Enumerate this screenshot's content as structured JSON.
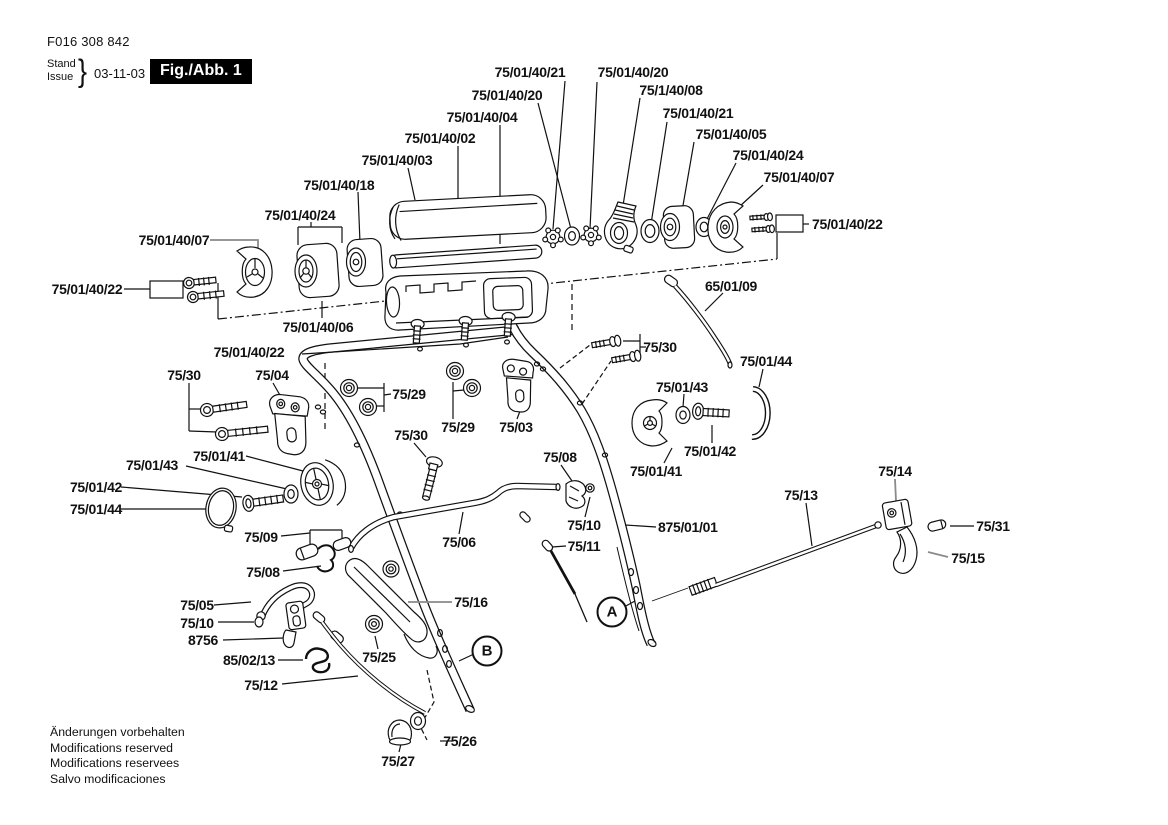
{
  "header": {
    "part_code": "F016 308 842",
    "stand_label": "Stand",
    "issue_label": "Issue",
    "brace": "}",
    "date": "03-11-03",
    "figure_badge": "Fig./Abb. 1"
  },
  "footer": {
    "lines": [
      "Änderungen vorbehalten",
      "Modifications reserved",
      "Modifications reservees",
      "Salvo modificaciones"
    ]
  },
  "colors": {
    "ink": "#111111",
    "badge_bg": "#000000",
    "badge_text": "#ffffff",
    "leader_gray": "#8a8a8a"
  },
  "view_markers": [
    {
      "letter": "A",
      "x": 612,
      "y": 612
    },
    {
      "letter": "B",
      "x": 487,
      "y": 651
    }
  ],
  "labels": [
    {
      "text": "75/01/40/21",
      "x": 530,
      "y": 72
    },
    {
      "text": "75/01/40/20",
      "x": 633,
      "y": 72
    },
    {
      "text": "75/01/40/20",
      "x": 507,
      "y": 95
    },
    {
      "text": "75/1/40/08",
      "x": 671,
      "y": 90
    },
    {
      "text": "75/01/40/04",
      "x": 482,
      "y": 117
    },
    {
      "text": "75/01/40/21",
      "x": 698,
      "y": 113
    },
    {
      "text": "75/01/40/02",
      "x": 440,
      "y": 138
    },
    {
      "text": "75/01/40/05",
      "x": 731,
      "y": 134
    },
    {
      "text": "75/01/40/03",
      "x": 397,
      "y": 160
    },
    {
      "text": "75/01/40/24",
      "x": 768,
      "y": 155
    },
    {
      "text": "75/01/40/18",
      "x": 339,
      "y": 185
    },
    {
      "text": "75/01/40/07",
      "x": 799,
      "y": 177
    },
    {
      "text": "75/01/40/24",
      "x": 300,
      "y": 215
    },
    {
      "text": "75/01/40/07",
      "x": 174,
      "y": 240
    },
    {
      "text": "75/01/40/22",
      "x": 812,
      "y": 224,
      "anchor": "start"
    },
    {
      "text": "75/01/40/22",
      "x": 87,
      "y": 289
    },
    {
      "text": "65/01/09",
      "x": 731,
      "y": 286
    },
    {
      "text": "75/01/40/06",
      "x": 318,
      "y": 327
    },
    {
      "text": "75/01/40/22",
      "x": 249,
      "y": 352
    },
    {
      "text": "75/30",
      "x": 184,
      "y": 375
    },
    {
      "text": "75/04",
      "x": 272,
      "y": 375
    },
    {
      "text": "75/29",
      "x": 409,
      "y": 394
    },
    {
      "text": "75/30",
      "x": 660,
      "y": 347
    },
    {
      "text": "75/01/44",
      "x": 766,
      "y": 361
    },
    {
      "text": "75/01/43",
      "x": 682,
      "y": 387
    },
    {
      "text": "75/29",
      "x": 458,
      "y": 427
    },
    {
      "text": "75/03",
      "x": 516,
      "y": 427
    },
    {
      "text": "75/30",
      "x": 411,
      "y": 435
    },
    {
      "text": "75/01/43",
      "x": 152,
      "y": 465
    },
    {
      "text": "75/01/41",
      "x": 219,
      "y": 456
    },
    {
      "text": "75/01/41",
      "x": 656,
      "y": 471
    },
    {
      "text": "75/01/42",
      "x": 710,
      "y": 451
    },
    {
      "text": "75/01/42",
      "x": 96,
      "y": 487
    },
    {
      "text": "75/01/44",
      "x": 96,
      "y": 509
    },
    {
      "text": "75/08",
      "x": 560,
      "y": 457
    },
    {
      "text": "75/14",
      "x": 895,
      "y": 471
    },
    {
      "text": "75/13",
      "x": 801,
      "y": 495
    },
    {
      "text": "75/10",
      "x": 584,
      "y": 525
    },
    {
      "text": "875/01/01",
      "x": 658,
      "y": 527,
      "anchor": "start"
    },
    {
      "text": "75/31",
      "x": 993,
      "y": 526
    },
    {
      "text": "75/11",
      "x": 584,
      "y": 546
    },
    {
      "text": "75/09",
      "x": 261,
      "y": 537
    },
    {
      "text": "75/06",
      "x": 459,
      "y": 542
    },
    {
      "text": "75/15",
      "x": 968,
      "y": 558
    },
    {
      "text": "75/08",
      "x": 263,
      "y": 572
    },
    {
      "text": "75/16",
      "x": 471,
      "y": 602
    },
    {
      "text": "75/05",
      "x": 197,
      "y": 605
    },
    {
      "text": "75/10",
      "x": 197,
      "y": 623
    },
    {
      "text": "8756",
      "x": 203,
      "y": 640
    },
    {
      "text": "85/02/13",
      "x": 249,
      "y": 660
    },
    {
      "text": "75/25",
      "x": 379,
      "y": 657
    },
    {
      "text": "75/12",
      "x": 261,
      "y": 685
    },
    {
      "text": "75/26",
      "x": 460,
      "y": 741
    },
    {
      "text": "75/27",
      "x": 398,
      "y": 761
    }
  ]
}
